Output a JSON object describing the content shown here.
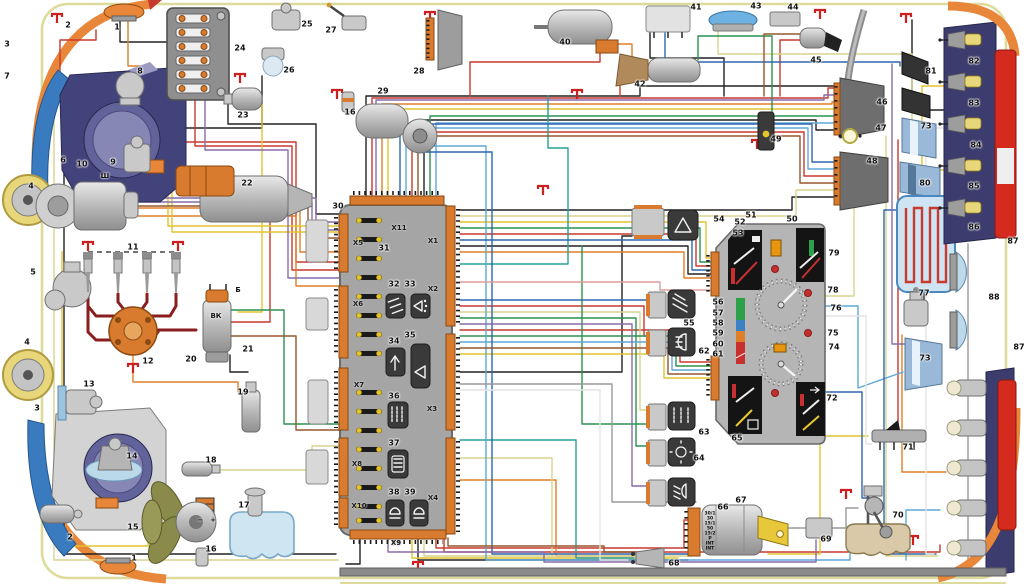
{
  "diagram_type": "automotive-wiring-schematic",
  "colors": {
    "background": "#ffffff",
    "body_outline_khaki": "#dedb9a",
    "central_block_fill": "#a5a5a5",
    "connector_orange": "#d97b2e",
    "fender_orange": "#e8873a",
    "tail_lamp_red": "#d42b1e",
    "headlight_navy": "#43437c",
    "instrument_panel_black": "#141414",
    "ground_symbol_red": "#cc2020",
    "wire_colors": [
      "#c8392e",
      "#8a1d1d",
      "#df7f28",
      "#e3c32e",
      "#d9d48e",
      "#2c9150",
      "#27a095",
      "#5fa8d8",
      "#2f66ad",
      "#8a6cab",
      "#96562e",
      "#dd9d9d",
      "#9a9a9a",
      "#e4e4e4",
      "#222222"
    ]
  },
  "icons": {
    "relay_32": "fan-relay-icon",
    "relay_33": "washer-relay-icon",
    "relay_34": "wiper-relay-icon",
    "relay_35": "horn-relay-icon",
    "relay_36": "heated-rear-window-relay-icon",
    "relay_37": "heater-relay-icon",
    "relay_38": "low-beam-relay-icon",
    "relay_39": "high-beam-relay-icon",
    "switch_54": "hazard-warning-icon",
    "switch_55": "heater-fan-icon",
    "switch_62": "headlight-icon",
    "switch_63": "heated-rear-window-icon",
    "switch_64": "parking-light-icon",
    "switch_66": "fog-light-icon",
    "cluster_72": "turn-arrow-icon",
    "ground": "chassis-ground-icon"
  },
  "labels": {
    "components": [
      {
        "t": "1",
        "x": 117,
        "y": 27
      },
      {
        "t": "2",
        "x": 68,
        "y": 25
      },
      {
        "t": "3",
        "x": 7,
        "y": 44
      },
      {
        "t": "7",
        "x": 7,
        "y": 76
      },
      {
        "t": "6",
        "x": 63,
        "y": 160
      },
      {
        "t": "10",
        "x": 82,
        "y": 164
      },
      {
        "t": "9",
        "x": 113,
        "y": 162
      },
      {
        "t": "8",
        "x": 140,
        "y": 71
      },
      {
        "t": "24",
        "x": 240,
        "y": 48
      },
      {
        "t": "25",
        "x": 307,
        "y": 24
      },
      {
        "t": "26",
        "x": 289,
        "y": 70
      },
      {
        "t": "23",
        "x": 243,
        "y": 115
      },
      {
        "t": "27",
        "x": 331,
        "y": 30
      },
      {
        "t": "16",
        "x": 350,
        "y": 112
      },
      {
        "t": "28",
        "x": 419,
        "y": 71
      },
      {
        "t": "29",
        "x": 383,
        "y": 91
      },
      {
        "t": "40",
        "x": 565,
        "y": 42
      },
      {
        "t": "41",
        "x": 696,
        "y": 7
      },
      {
        "t": "43",
        "x": 756,
        "y": 6
      },
      {
        "t": "42",
        "x": 640,
        "y": 84
      },
      {
        "t": "44",
        "x": 793,
        "y": 7
      },
      {
        "t": "45",
        "x": 816,
        "y": 60
      },
      {
        "t": "46",
        "x": 882,
        "y": 102
      },
      {
        "t": "47",
        "x": 881,
        "y": 128
      },
      {
        "t": "48",
        "x": 872,
        "y": 161
      },
      {
        "t": "49",
        "x": 776,
        "y": 139
      },
      {
        "t": "81",
        "x": 931,
        "y": 71
      },
      {
        "t": "73",
        "x": 926,
        "y": 126
      },
      {
        "t": "80",
        "x": 925,
        "y": 183
      },
      {
        "t": "82",
        "x": 974,
        "y": 61
      },
      {
        "t": "83",
        "x": 974,
        "y": 103
      },
      {
        "t": "84",
        "x": 976,
        "y": 145
      },
      {
        "t": "85",
        "x": 974,
        "y": 186
      },
      {
        "t": "86",
        "x": 974,
        "y": 227
      },
      {
        "t": "87",
        "x": 1013,
        "y": 241
      },
      {
        "t": "4",
        "x": 31,
        "y": 186
      },
      {
        "t": "5",
        "x": 33,
        "y": 272
      },
      {
        "t": "4",
        "x": 27,
        "y": 342
      },
      {
        "t": "11",
        "x": 133,
        "y": 247
      },
      {
        "t": "12",
        "x": 148,
        "y": 361
      },
      {
        "t": "20",
        "x": 191,
        "y": 359
      },
      {
        "t": "21",
        "x": 248,
        "y": 349
      },
      {
        "t": "22",
        "x": 247,
        "y": 183
      },
      {
        "t": "13",
        "x": 89,
        "y": 384
      },
      {
        "t": "3",
        "x": 37,
        "y": 408
      },
      {
        "t": "14",
        "x": 132,
        "y": 456
      },
      {
        "t": "18",
        "x": 211,
        "y": 460
      },
      {
        "t": "19",
        "x": 243,
        "y": 392
      },
      {
        "t": "15",
        "x": 133,
        "y": 527
      },
      {
        "t": "17",
        "x": 244,
        "y": 505
      },
      {
        "t": "16",
        "x": 211,
        "y": 549
      },
      {
        "t": "2",
        "x": 70,
        "y": 537
      },
      {
        "t": "1",
        "x": 134,
        "y": 558
      },
      {
        "t": "30",
        "x": 338,
        "y": 206
      },
      {
        "t": "31",
        "x": 384,
        "y": 248
      },
      {
        "t": "32",
        "x": 394,
        "y": 284
      },
      {
        "t": "33",
        "x": 410,
        "y": 284
      },
      {
        "t": "34",
        "x": 394,
        "y": 341
      },
      {
        "t": "35",
        "x": 410,
        "y": 335
      },
      {
        "t": "36",
        "x": 394,
        "y": 396
      },
      {
        "t": "37",
        "x": 394,
        "y": 443
      },
      {
        "t": "38",
        "x": 394,
        "y": 492
      },
      {
        "t": "39",
        "x": 410,
        "y": 492
      },
      {
        "t": "54",
        "x": 719,
        "y": 219
      },
      {
        "t": "51",
        "x": 751,
        "y": 215
      },
      {
        "t": "52",
        "x": 740,
        "y": 222
      },
      {
        "t": "53",
        "x": 738,
        "y": 233
      },
      {
        "t": "50",
        "x": 792,
        "y": 219
      },
      {
        "t": "79",
        "x": 834,
        "y": 253
      },
      {
        "t": "78",
        "x": 833,
        "y": 290
      },
      {
        "t": "76",
        "x": 836,
        "y": 308
      },
      {
        "t": "75",
        "x": 833,
        "y": 333
      },
      {
        "t": "74",
        "x": 834,
        "y": 347
      },
      {
        "t": "72",
        "x": 832,
        "y": 398
      },
      {
        "t": "65",
        "x": 737,
        "y": 438
      },
      {
        "t": "56",
        "x": 718,
        "y": 302
      },
      {
        "t": "57",
        "x": 718,
        "y": 313
      },
      {
        "t": "58",
        "x": 718,
        "y": 323
      },
      {
        "t": "59",
        "x": 718,
        "y": 333
      },
      {
        "t": "60",
        "x": 718,
        "y": 344
      },
      {
        "t": "61",
        "x": 718,
        "y": 354
      },
      {
        "t": "55",
        "x": 689,
        "y": 323
      },
      {
        "t": "62",
        "x": 704,
        "y": 351
      },
      {
        "t": "63",
        "x": 704,
        "y": 432
      },
      {
        "t": "64",
        "x": 699,
        "y": 458
      },
      {
        "t": "66",
        "x": 723,
        "y": 507
      },
      {
        "t": "67",
        "x": 741,
        "y": 500
      },
      {
        "t": "68",
        "x": 674,
        "y": 563
      },
      {
        "t": "69",
        "x": 826,
        "y": 539
      },
      {
        "t": "70",
        "x": 898,
        "y": 515
      },
      {
        "t": "71",
        "x": 908,
        "y": 447
      },
      {
        "t": "77",
        "x": 924,
        "y": 293
      },
      {
        "t": "73",
        "x": 925,
        "y": 358
      },
      {
        "t": "88",
        "x": 994,
        "y": 297
      },
      {
        "t": "87",
        "x": 1019,
        "y": 347
      }
    ],
    "connectors": [
      {
        "t": "X11",
        "x": 399,
        "y": 228
      },
      {
        "t": "X5",
        "x": 358,
        "y": 243
      },
      {
        "t": "X1",
        "x": 433,
        "y": 241
      },
      {
        "t": "X2",
        "x": 433,
        "y": 289
      },
      {
        "t": "X6",
        "x": 358,
        "y": 304
      },
      {
        "t": "X7",
        "x": 359,
        "y": 385
      },
      {
        "t": "X3",
        "x": 432,
        "y": 409
      },
      {
        "t": "X8",
        "x": 357,
        "y": 464
      },
      {
        "t": "X4",
        "x": 433,
        "y": 498
      },
      {
        "t": "X10",
        "x": 359,
        "y": 506
      },
      {
        "t": "X9",
        "x": 396,
        "y": 543
      }
    ],
    "terminals": [
      {
        "t": "Ш",
        "x": 105,
        "y": 176
      },
      {
        "t": "Б",
        "x": 238,
        "y": 290
      },
      {
        "t": "ВК",
        "x": 216,
        "y": 316
      },
      {
        "t": "−",
        "x": 200,
        "y": 520
      },
      {
        "t": "+",
        "x": 213,
        "y": 520
      }
    ],
    "ignition_terminals": [
      {
        "t": "30/1",
        "x": 710,
        "y": 514
      },
      {
        "t": "30",
        "x": 710,
        "y": 519
      },
      {
        "t": "15/1",
        "x": 710,
        "y": 524
      },
      {
        "t": "50",
        "x": 710,
        "y": 529
      },
      {
        "t": "15/2",
        "x": 710,
        "y": 534
      },
      {
        "t": "P",
        "x": 710,
        "y": 539
      },
      {
        "t": "INT",
        "x": 710,
        "y": 544
      },
      {
        "t": "INT",
        "x": 710,
        "y": 549
      }
    ]
  }
}
